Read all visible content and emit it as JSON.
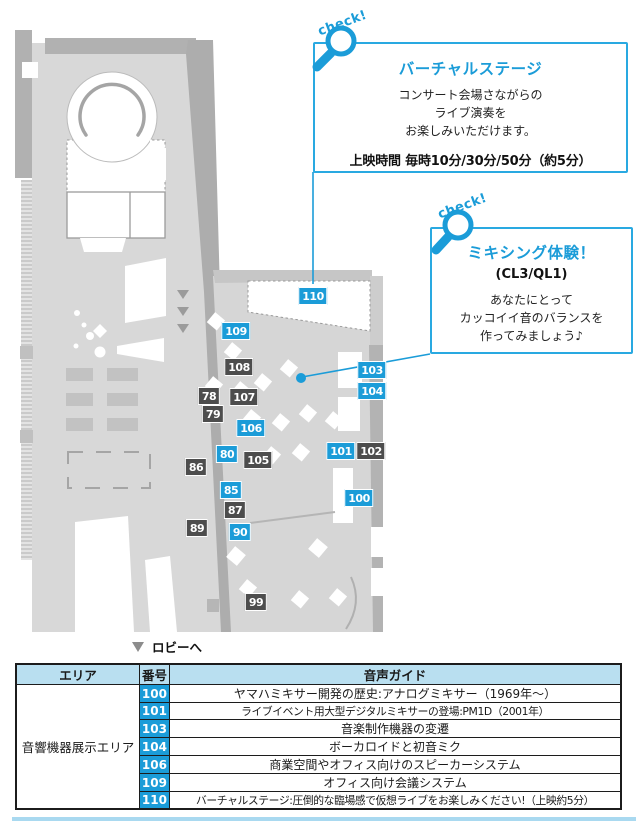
{
  "colors": {
    "accent_blue": "#1b9cd8",
    "callout_border": "#29a9e1",
    "marker_dark": "#4d4d4d",
    "table_header_bg": "#b9dff0",
    "bottom_rule": "#a9d9f0"
  },
  "callouts": [
    {
      "check_label": "check!",
      "title": "バーチャルステージ",
      "body_lines": [
        "コンサート会場さながらの",
        "ライブ演奏を",
        "お楽しみいただけます。"
      ],
      "footer": "上映時間 毎時10分/30分/50分（約5分）"
    },
    {
      "check_label": "check!",
      "title": "ミキシング体験！",
      "subtitle": "(CL3/QL1)",
      "body_lines": [
        "あなたにとって",
        "カッコイイ音のバランスを",
        "作ってみましょう♪"
      ]
    }
  ],
  "map": {
    "lobby_note": "ロビーへ",
    "markers": [
      {
        "id": "110",
        "x": 313,
        "y": 296,
        "variant": "blue"
      },
      {
        "id": "109",
        "x": 236,
        "y": 331,
        "variant": "blue"
      },
      {
        "id": "108",
        "x": 239,
        "y": 367,
        "variant": "dark"
      },
      {
        "id": "78",
        "x": 209,
        "y": 396,
        "variant": "dark"
      },
      {
        "id": "79",
        "x": 213,
        "y": 414,
        "variant": "dark"
      },
      {
        "id": "107",
        "x": 244,
        "y": 397,
        "variant": "dark"
      },
      {
        "id": "106",
        "x": 251,
        "y": 428,
        "variant": "blue"
      },
      {
        "id": "80",
        "x": 227,
        "y": 454,
        "variant": "blue"
      },
      {
        "id": "105",
        "x": 258,
        "y": 460,
        "variant": "dark"
      },
      {
        "id": "86",
        "x": 196,
        "y": 467,
        "variant": "dark"
      },
      {
        "id": "85",
        "x": 231,
        "y": 490,
        "variant": "blue"
      },
      {
        "id": "87",
        "x": 235,
        "y": 510,
        "variant": "dark"
      },
      {
        "id": "89",
        "x": 197,
        "y": 528,
        "variant": "dark"
      },
      {
        "id": "90",
        "x": 240,
        "y": 532,
        "variant": "blue"
      },
      {
        "id": "99",
        "x": 256,
        "y": 602,
        "variant": "dark"
      },
      {
        "id": "103",
        "x": 372,
        "y": 370,
        "variant": "blue"
      },
      {
        "id": "104",
        "x": 372,
        "y": 391,
        "variant": "blue"
      },
      {
        "id": "101",
        "x": 341,
        "y": 451,
        "variant": "blue"
      },
      {
        "id": "102",
        "x": 371,
        "y": 451,
        "variant": "dark"
      },
      {
        "id": "100",
        "x": 359,
        "y": 498,
        "variant": "blue"
      }
    ]
  },
  "table": {
    "headers": [
      "エリア",
      "番号",
      "音声ガイド"
    ],
    "area_label": "音響機器展示エリア",
    "rows": [
      {
        "no": "100",
        "text": "ヤマハミキサー開発の歴史:アナログミキサー（1969年〜）"
      },
      {
        "no": "101",
        "text": "ライブイベント用大型デジタルミキサーの登場:PM1D（2001年）"
      },
      {
        "no": "103",
        "text": "音楽制作機器の変遷"
      },
      {
        "no": "104",
        "text": "ボーカロイドと初音ミク"
      },
      {
        "no": "106",
        "text": "商業空間やオフィス向けのスピーカーシステム"
      },
      {
        "no": "109",
        "text": "オフィス向け会議システム"
      },
      {
        "no": "110",
        "text": "バーチャルステージ:圧倒的な臨場感で仮想ライブをお楽しみください!（上映約5分）"
      }
    ]
  }
}
